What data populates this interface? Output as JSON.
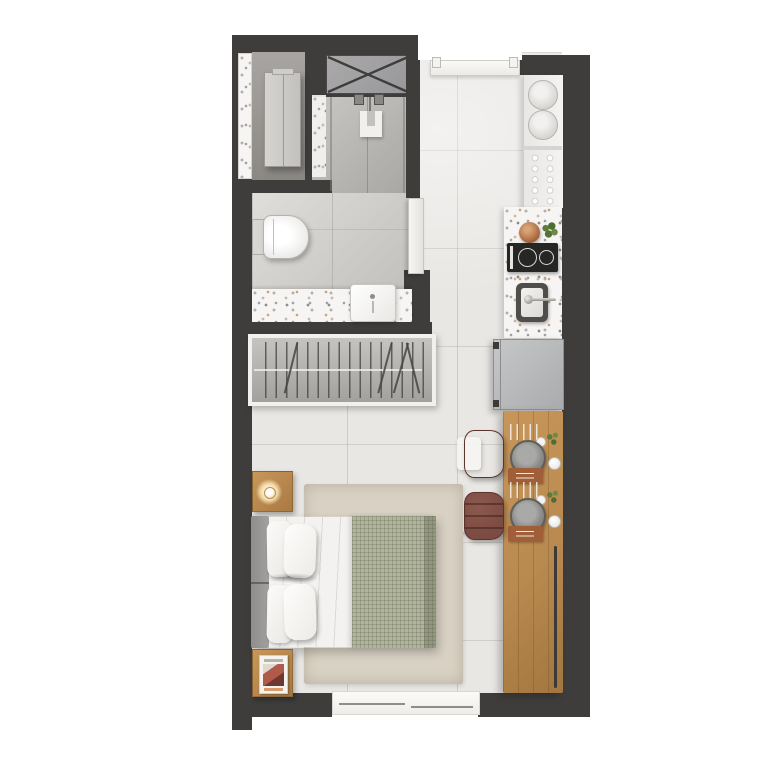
{
  "document_title": "Studio apartment floor plan — top view",
  "palette": {
    "wall": "#3e3d3c",
    "floor": "#e9e7e4",
    "floor_bath": "#c9c7c4",
    "floor_shower": "#b3b1af",
    "floor_niche": "#96938f",
    "terrazzo": "#f6f5f3",
    "wood": "#b98a50",
    "wood_light": "#c89659",
    "wood_dark": "#a2763f",
    "chair": "#7c4b42",
    "blanket": "#b1b39d",
    "rug": "#d9d2c4",
    "fridge": "#b7b9bb",
    "cooktop": "#262624",
    "headboard": "#a3a19f",
    "lamp_glow": "#f3d9a6",
    "greenery": "#55713a",
    "book_red": "#b05a4a"
  },
  "rooms": {
    "entry": {
      "name": "Entry"
    },
    "wardrobe_niche": {
      "name": "Wardrobe niche"
    },
    "shower": {
      "name": "Shower"
    },
    "bathroom": {
      "name": "Bathroom"
    },
    "kitchen": {
      "name": "Kitchen"
    },
    "living_area": {
      "name": "Living and sleeping area"
    },
    "window": {
      "name": "Sliding window"
    }
  },
  "furniture": {
    "duct_shaft": {
      "name": "Service shaft (X marked)"
    },
    "wardrobe_cabinet": {
      "name": "Tall wardrobe cabinet"
    },
    "toilet": {
      "name": "Toilet"
    },
    "vanity_sink": {
      "name": "Vanity washbasin"
    },
    "open_closet": {
      "name": "Open closet with hangers"
    },
    "dish_rack": {
      "name": "Dish rack with plates"
    },
    "glass_rack": {
      "name": "Glass rack"
    },
    "cutting_board": {
      "name": "Cutting board with bowl and greens"
    },
    "cooktop": {
      "name": "Two burner cooktop"
    },
    "kitchen_sink": {
      "name": "Kitchen sink with faucet"
    },
    "fridge": {
      "name": "Refrigerator"
    },
    "dining_table": {
      "name": "Wooden dining counter with two place settings"
    },
    "chairs": {
      "name": "Upholstered dining chairs"
    },
    "bed": {
      "name": "Double bed with plaid blanket"
    },
    "rug": {
      "name": "Area rug"
    },
    "nightstand_lamp": {
      "name": "Nightstand with lamp"
    },
    "nightstand_book": {
      "name": "Nightstand with magazine"
    }
  },
  "counts": {
    "rack_plates": 2,
    "glasses": 10,
    "burners": 2,
    "place_settings": 2,
    "chairs": 2,
    "pillows": 4,
    "hangers": 16
  }
}
